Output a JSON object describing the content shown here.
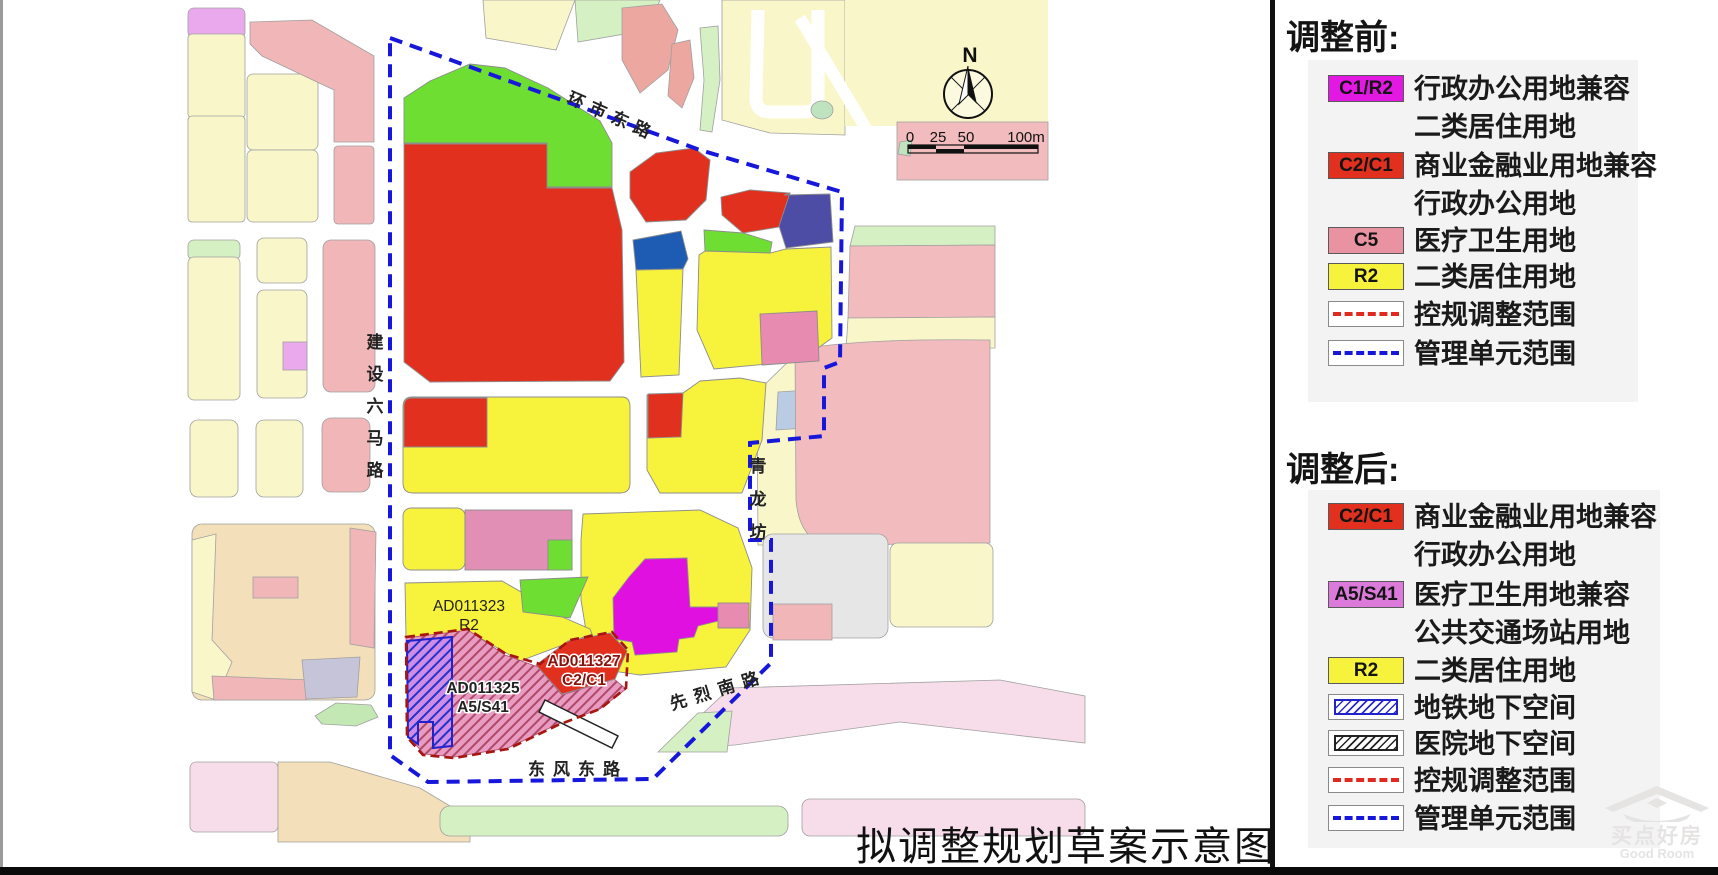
{
  "page": {
    "caption": "拟调整规划草案示意图"
  },
  "colors": {
    "vivid_red": "#E2301F",
    "bright_yellow": "#F7F23C",
    "bright_green": "#6FDE32",
    "magenta": "#E010E0",
    "dark_blue": "#1E5CB3",
    "indigo": "#4D4DA6",
    "rose_pink": "#E78CB0",
    "c5_pink": "#E993A2",
    "orchid": "#DB7ADB",
    "legend_magenta": "#E318E3",
    "boundary_blue": "#1717DC",
    "adjust_red_dash": "#A61510",
    "legend_red_dash": "#E02A1F",
    "pale_yellow": "#F9F7C9",
    "context_pink": "#F0B6B8",
    "salmon": "#EBA7A0",
    "pale_green": "#D5F0C2",
    "tan": "#F3DFB9",
    "band_pink": "#F7DCEA",
    "gray_parcel": "#E6E6E6",
    "light_blue": "#BACCE4",
    "lavender_gray": "#C6C4D8",
    "violet": "#E9A9EC",
    "hatch_pink_base": "#E89CC2",
    "hatch_pink_line": "#B04868",
    "hatch_violet_base": "#D08CE4",
    "hatch_blue_line": "#2233CC"
  },
  "map": {
    "north_label": "N",
    "scale_bar": {
      "tick0": "0",
      "tick25": "25",
      "tick50": "50",
      "tick100": "100m"
    },
    "roads": {
      "huanshi_dong": "环市东路",
      "jianshe_chars": [
        "建",
        "设",
        "六",
        "马",
        "路"
      ],
      "qinglong_chars": [
        "青",
        "龙",
        "坊"
      ],
      "xianlie_nan": "先烈南路",
      "dongfeng_dong": "东风东路"
    },
    "parcel_labels": {
      "p1323": {
        "code": "AD011323",
        "use": "R2"
      },
      "p1325": {
        "code": "AD011325",
        "use": "A5/S41"
      },
      "p1327": {
        "code": "AD011327",
        "use": "C2/C1"
      }
    }
  },
  "legend_before": {
    "title": "调整前:",
    "items": [
      {
        "chip": "C1/R2",
        "label": "行政办公用地兼容",
        "label2": "二类居住用地"
      },
      {
        "chip": "C2/C1",
        "label": "商业金融业用地兼容",
        "label2": "行政办公用地"
      },
      {
        "chip": "C5",
        "label": "医疗卫生用地"
      },
      {
        "chip": "R2",
        "label": "二类居住用地"
      },
      {
        "label": "控规调整范围"
      },
      {
        "label": "管理单元范围"
      }
    ]
  },
  "legend_after": {
    "title": "调整后:",
    "items": [
      {
        "chip": "C2/C1",
        "label": "商业金融业用地兼容",
        "label2": "行政办公用地"
      },
      {
        "chip": "A5/S41",
        "label": "医疗卫生用地兼容",
        "label2": "公共交通场站用地"
      },
      {
        "chip": "R2",
        "label": "二类居住用地"
      },
      {
        "label": "地铁地下空间"
      },
      {
        "label": "医院地下空间"
      },
      {
        "label": "控规调整范围"
      },
      {
        "label": "管理单元范围"
      }
    ]
  },
  "watermark": {
    "cn": "买点好房",
    "en": "Good Room"
  }
}
